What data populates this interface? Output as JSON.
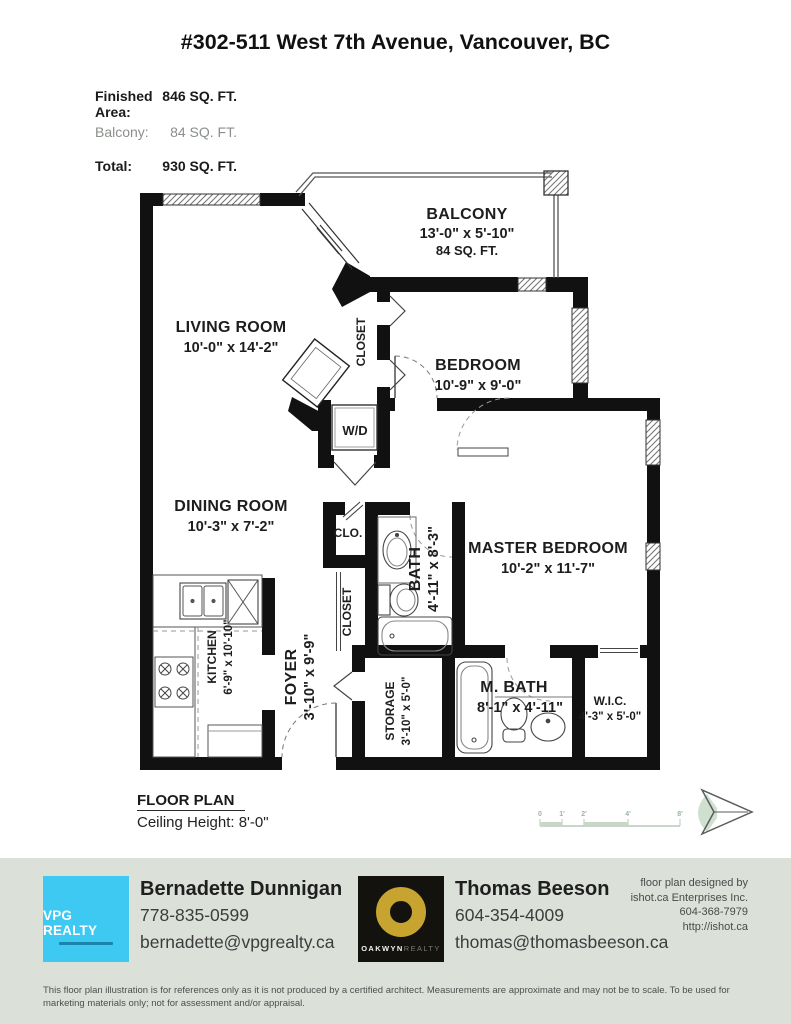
{
  "header": {
    "title": "#302-511 West 7th Avenue, Vancouver, BC",
    "rows": [
      {
        "label": "Finished Area:",
        "value": "846 SQ. FT."
      },
      {
        "label": "Balcony:",
        "value": "84 SQ. FT."
      },
      {
        "label": "Total:",
        "value": "930 SQ. FT."
      }
    ]
  },
  "plan": {
    "balcony": {
      "name": "BALCONY",
      "dims": "13'-0\" x 5'-10\"",
      "area": "84 SQ. FT."
    },
    "living": {
      "name": "LIVING ROOM",
      "dims": "10'-0\" x 14'-2\""
    },
    "bedroom": {
      "name": "BEDROOM",
      "dims": "10'-9\" x 9'-0\""
    },
    "dining": {
      "name": "DINING ROOM",
      "dims": "10'-3\" x 7'-2\""
    },
    "master": {
      "name": "MASTER BEDROOM",
      "dims": "10'-2\" x 11'-7\""
    },
    "bath": {
      "name": "BATH",
      "dims": "4'-11\" x 8'-3\""
    },
    "kitchen": {
      "name": "KITCHEN",
      "dims": "6'-9\" x 10'-10\""
    },
    "foyer": {
      "name": "FOYER",
      "dims": "3'-10\" x 9'-9\""
    },
    "storage": {
      "name": "STORAGE",
      "dims": "3'-10\" x 5'-0\""
    },
    "mbath": {
      "name": "M. BATH",
      "dims": "8'-1\" x 4'-11\""
    },
    "wic": {
      "name": "W.I.C.",
      "dims": "4'-3\" x 5'-0\""
    },
    "closet_bedroom": "CLOSET",
    "closet_small": "CLO.",
    "closet_foyer": "CLOSET",
    "wd": "W/D",
    "caption": "FLOOR PLAN",
    "ceiling": "Ceiling Height: 8'-0\"",
    "scale_ticks": [
      "0",
      "1'",
      "2'",
      "4'",
      "8'"
    ]
  },
  "footer": {
    "brand1": "VPG REALTY",
    "agent1": {
      "name": "Bernadette Dunnigan",
      "phone": "778-835-0599",
      "email": "bernadette@vpgrealty.ca"
    },
    "brand2_primary": "OAKWYN",
    "brand2_secondary": "REALTY",
    "agent2": {
      "name": "Thomas Beeson",
      "phone": "604-354-4009",
      "email": "thomas@thomasbeeson.ca"
    },
    "credit": {
      "l1": "floor plan designed by",
      "l2": "ishot.ca Enterprises Inc.",
      "l3": "604-368-7979",
      "l4": "http://ishot.ca"
    },
    "disclaimer": "This floor plan illustration is for references only as it is not produced by a certified architect. Measurements are approximate and may not be to scale. To be used for marketing materials only; not for assessment and/or appraisal."
  }
}
